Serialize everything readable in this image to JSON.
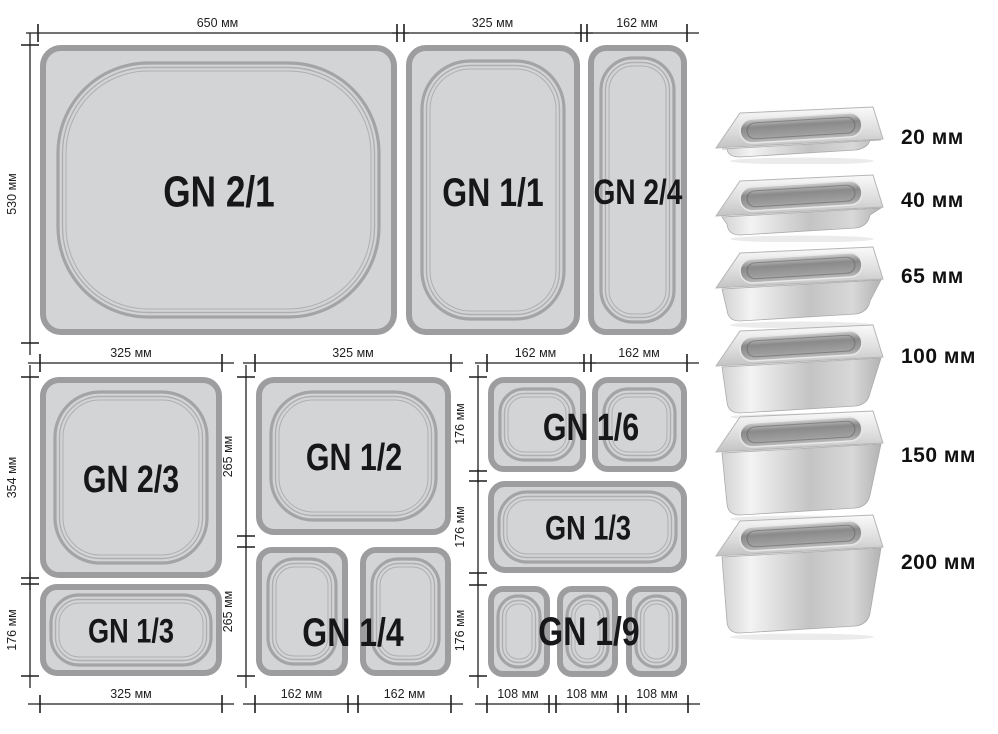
{
  "colors": {
    "background": "#ffffff",
    "pan_fill": "#d3d4d6",
    "pan_border": "#9d9da0",
    "rim_line": "#a4a4a7",
    "rim_thin": "#afafb2",
    "dim_line": "#1f1f1f",
    "label_text": "#17171a",
    "depth_text": "#111111"
  },
  "diagram": {
    "unit": "мм",
    "pans": [
      {
        "name": "gn-2-1",
        "label": "GN 2/1",
        "x": 40,
        "y": 45,
        "w": 357,
        "h": 290,
        "r": 18,
        "rim_inset": 18,
        "rim_r": 90,
        "font": 44,
        "label_x": 219,
        "label_y": 192
      },
      {
        "name": "gn-1-1",
        "label": "GN 1/1",
        "x": 406,
        "y": 45,
        "w": 174,
        "h": 290,
        "r": 17,
        "rim_inset": 16,
        "rim_r": 48,
        "font": 40,
        "label_x": 493,
        "label_y": 192
      },
      {
        "name": "gn-2-4",
        "label": "GN 2/4",
        "x": 588,
        "y": 45,
        "w": 99,
        "h": 290,
        "r": 15,
        "rim_inset": 13,
        "rim_r": 32,
        "font": 35,
        "label_x": 638,
        "label_y": 192
      },
      {
        "name": "gn-2-3",
        "label": "GN 2/3",
        "x": 40,
        "y": 377,
        "w": 182,
        "h": 201,
        "r": 16,
        "rim_inset": 15,
        "rim_r": 45,
        "font": 38,
        "label_x": 131,
        "label_y": 480
      },
      {
        "name": "gn-1-3-left",
        "label": "GN 1/3",
        "x": 40,
        "y": 584,
        "w": 182,
        "h": 92,
        "r": 14,
        "rim_inset": 11,
        "rim_r": 28,
        "font": 34,
        "label_x": 131,
        "label_y": 631
      },
      {
        "name": "gn-1-2",
        "label": "GN 1/2",
        "x": 256,
        "y": 377,
        "w": 195,
        "h": 158,
        "r": 15,
        "rim_inset": 15,
        "rim_r": 42,
        "font": 38,
        "label_x": 354,
        "label_y": 458
      },
      {
        "name": "gn-1-4-a",
        "x": 256,
        "y": 547,
        "w": 92,
        "h": 129,
        "r": 13,
        "rim_inset": 12,
        "rim_r": 26
      },
      {
        "name": "gn-1-4-b",
        "x": 360,
        "y": 547,
        "w": 91,
        "h": 129,
        "r": 13,
        "rim_inset": 12,
        "rim_r": 26
      },
      {
        "name": "gn-1-6-a",
        "x": 488,
        "y": 377,
        "w": 98,
        "h": 95,
        "r": 13,
        "rim_inset": 12,
        "rim_r": 24
      },
      {
        "name": "gn-1-6-b",
        "x": 592,
        "y": 377,
        "w": 95,
        "h": 95,
        "r": 13,
        "rim_inset": 12,
        "rim_r": 24
      },
      {
        "name": "gn-1-3-right",
        "label": "GN 1/3",
        "x": 488,
        "y": 481,
        "w": 199,
        "h": 92,
        "r": 14,
        "rim_inset": 11,
        "rim_r": 28,
        "font": 34,
        "label_x": 588,
        "label_y": 528
      },
      {
        "name": "gn-1-9-a",
        "x": 488,
        "y": 586,
        "w": 62,
        "h": 91,
        "r": 12,
        "rim_inset": 10,
        "rim_r": 20
      },
      {
        "name": "gn-1-9-b",
        "x": 557,
        "y": 586,
        "w": 61,
        "h": 91,
        "r": 12,
        "rim_inset": 10,
        "rim_r": 20
      },
      {
        "name": "gn-1-9-c",
        "x": 626,
        "y": 586,
        "w": 61,
        "h": 91,
        "r": 12,
        "rim_inset": 10,
        "rim_r": 20
      }
    ],
    "span_labels": [
      {
        "name": "gn-1-4",
        "label": "GN 1/4",
        "x": 353,
        "y": 632,
        "font": 40
      },
      {
        "name": "gn-1-6",
        "label": "GN 1/6",
        "x": 591,
        "y": 428,
        "font": 38
      },
      {
        "name": "gn-1-9",
        "label": "GN 1/9",
        "x": 589,
        "y": 631,
        "font": 40
      }
    ],
    "h_dims": [
      {
        "label": "650 мм",
        "x1": 38,
        "x2": 397,
        "y": 33
      },
      {
        "label": "325 мм",
        "x1": 404,
        "x2": 581,
        "y": 33
      },
      {
        "label": "162 мм",
        "x1": 587,
        "x2": 687,
        "y": 33
      },
      {
        "label": "325 мм",
        "x1": 40,
        "x2": 222,
        "y": 363
      },
      {
        "label": "325 мм",
        "x1": 255,
        "x2": 451,
        "y": 363
      },
      {
        "label": "162 мм",
        "x1": 487,
        "x2": 584,
        "y": 363
      },
      {
        "label": "162 мм",
        "x1": 591,
        "x2": 687,
        "y": 363
      },
      {
        "label": "325 мм",
        "x1": 40,
        "x2": 222,
        "y": 704
      },
      {
        "label": "162 мм",
        "x1": 255,
        "x2": 348,
        "y": 704
      },
      {
        "label": "162 мм",
        "x1": 358,
        "x2": 451,
        "y": 704
      },
      {
        "label": "108 мм",
        "x1": 487,
        "x2": 549,
        "y": 704
      },
      {
        "label": "108 мм",
        "x1": 556,
        "x2": 618,
        "y": 704
      },
      {
        "label": "108 мм",
        "x1": 626,
        "x2": 688,
        "y": 704
      }
    ],
    "v_dims": [
      {
        "label": "530 мм",
        "x": 30,
        "y1": 45,
        "y2": 343
      },
      {
        "label": "354 мм",
        "x": 30,
        "y1": 377,
        "y2": 578
      },
      {
        "label": "176 мм",
        "x": 30,
        "y1": 584,
        "y2": 676
      },
      {
        "label": "265 мм",
        "x": 246,
        "y1": 377,
        "y2": 536
      },
      {
        "label": "265 мм",
        "x": 246,
        "y1": 547,
        "y2": 676
      },
      {
        "label": "176 мм",
        "x": 478,
        "y1": 377,
        "y2": 471
      },
      {
        "label": "176 мм",
        "x": 478,
        "y1": 481,
        "y2": 573
      },
      {
        "label": "176 мм",
        "x": 478,
        "y1": 585,
        "y2": 676
      }
    ]
  },
  "depth_chart": {
    "type": "table",
    "title": "GN pan depths",
    "items": [
      {
        "label": "20 мм",
        "depth_mm": 20
      },
      {
        "label": "40 мм",
        "depth_mm": 40
      },
      {
        "label": "65 мм",
        "depth_mm": 65
      },
      {
        "label": "100 мм",
        "depth_mm": 100
      },
      {
        "label": "150 мм",
        "depth_mm": 150
      },
      {
        "label": "200 мм",
        "depth_mm": 200
      }
    ]
  }
}
